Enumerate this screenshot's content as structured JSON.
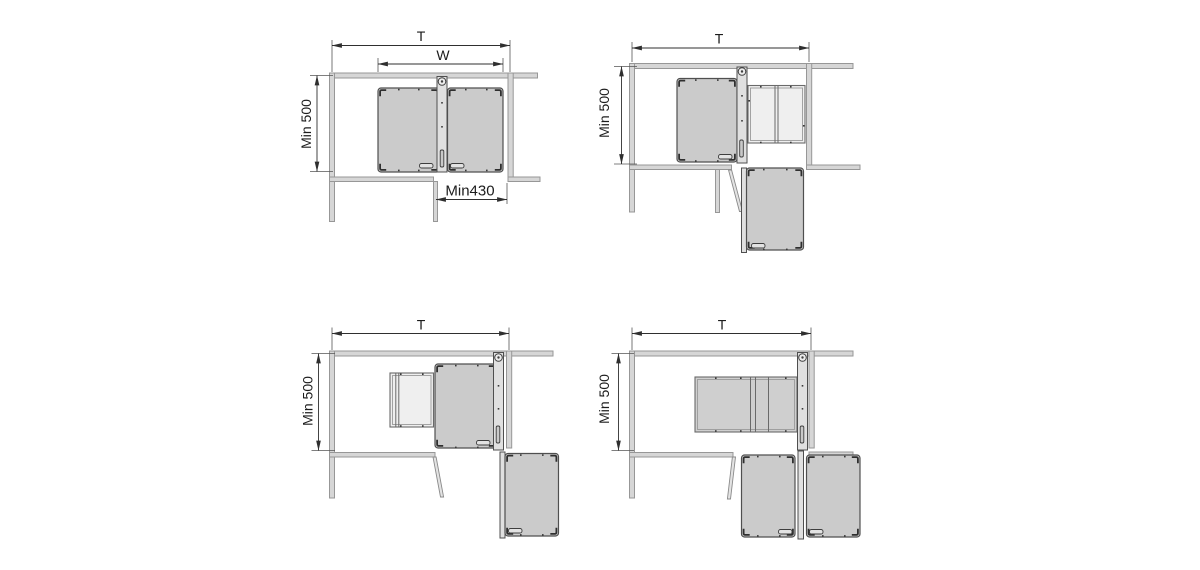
{
  "canvas": {
    "width": 1200,
    "height": 570,
    "background": "#ffffff"
  },
  "colors": {
    "wall_fill": "#d6d6d6",
    "wall_stroke": "#979797",
    "tray_fill": "#cbcbcb",
    "tray_stroke": "#4f4f4f",
    "open_tray_fill": "#efefef",
    "rail_fill": "#e0e0e0",
    "dimension_stroke": "#2f2f2f",
    "label_color": "#1c1c1c"
  },
  "diagrams": [
    {
      "name": "both-trays-inside",
      "labels": {
        "total_width": "T",
        "unit_width": "W",
        "min_depth": "Min 500",
        "min_opening": "Min430"
      }
    },
    {
      "name": "one-tray-swung-one-extended",
      "labels": {
        "total_width": "T",
        "min_depth": "Min 500"
      }
    },
    {
      "name": "unit-rotated-one-extended",
      "labels": {
        "total_width": "T",
        "min_depth": "Min 500"
      }
    },
    {
      "name": "unit-rotated-two-extended",
      "labels": {
        "total_width": "T",
        "min_depth": "Min 500"
      }
    }
  ]
}
